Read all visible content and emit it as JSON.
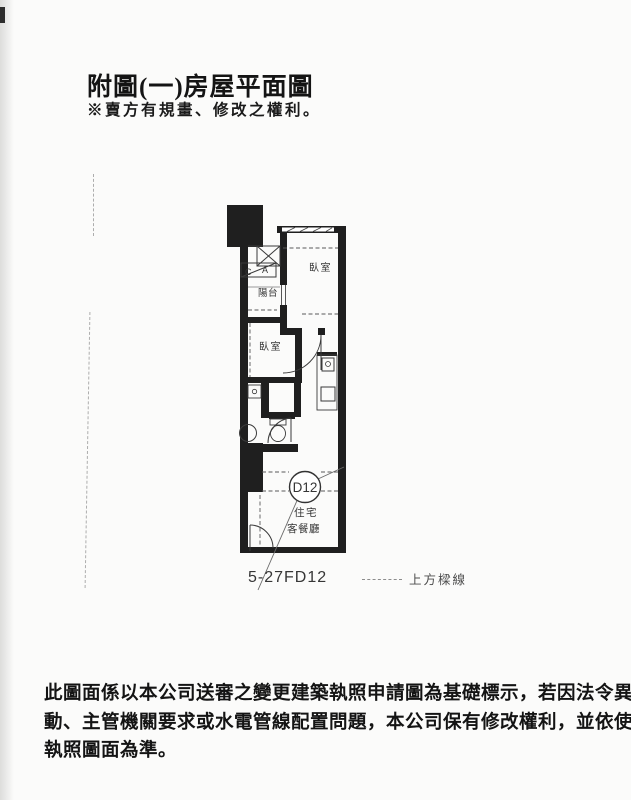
{
  "page": {
    "title": "附圖(一)房屋平面圖",
    "subtitle": "※賣方有規畫、修改之權利。",
    "footer_lines": [
      "此圖面係以本公司送審之變更建築執照申請圖為基礎標示，若因法令異",
      "動、主管機關要求或水電管線配置問題，本公司保有修改權利，並依使用",
      "執照圖面為準。"
    ]
  },
  "plan": {
    "bedroom1_label": "臥室",
    "bedroom2_label": "臥室",
    "balcony_label": "陽台",
    "box_letter_c": "C",
    "box_letter_a": "A",
    "unit_circle_label": "D12",
    "unit_type_label": "住宅",
    "living_dining_label": "客餐廳",
    "plan_code": "5-27FD12",
    "legend_beam_label": "上方樑線",
    "colors": {
      "wall": "#1f1f1f",
      "line": "#3a3a3a",
      "dash": "#5a5a5a",
      "label": "#363636"
    }
  }
}
